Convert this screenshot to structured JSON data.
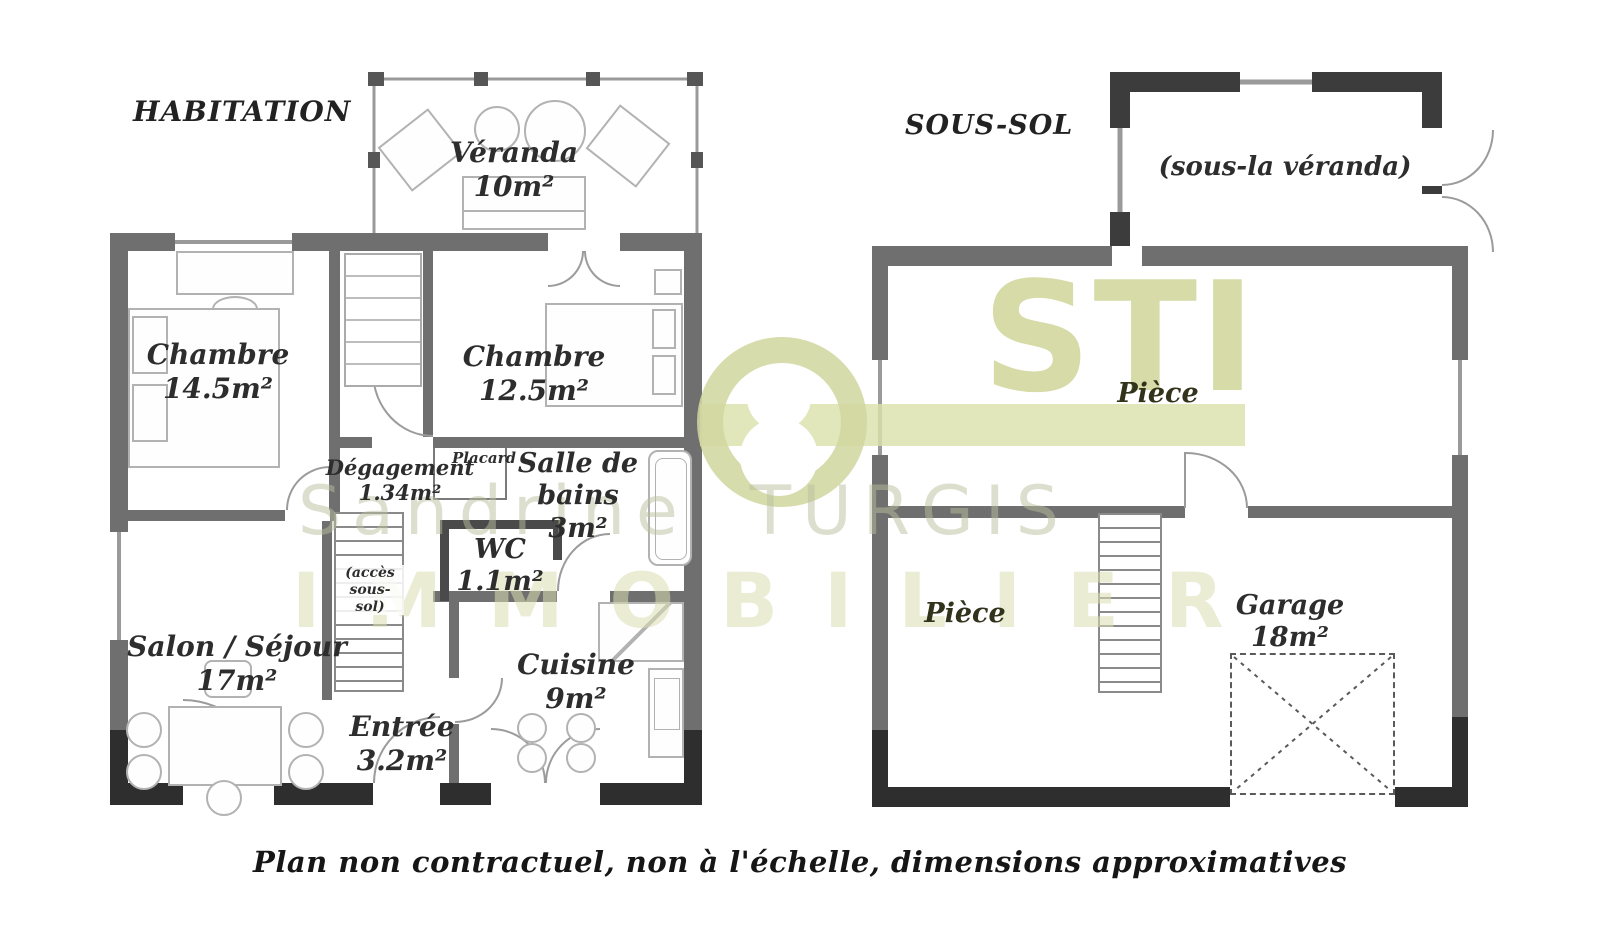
{
  "titles": {
    "left": "HABITATION",
    "right": "SOUS-SOL"
  },
  "caption": "Plan non contractuel, non à l'échelle, dimensions approximatives",
  "watermark": {
    "logo": "STI",
    "name": "Sandrine TURGIS",
    "word": "IMMOBILIER",
    "color": "#d5daa5"
  },
  "habitation": {
    "veranda": {
      "name": "Véranda",
      "area": "10m²"
    },
    "chambre1": {
      "name": "Chambre",
      "area": "14.5m²"
    },
    "chambre2": {
      "name": "Chambre",
      "area": "12.5m²"
    },
    "degagement": {
      "name": "Dégagement",
      "area": "1.34m²"
    },
    "placard": {
      "name": "Placard"
    },
    "sdb": {
      "name": "Salle de bains",
      "area": "3m²"
    },
    "wc": {
      "name": "WC",
      "area": "1.1m²"
    },
    "salon": {
      "name": "Salon / Séjour",
      "area": "17m²"
    },
    "acces": {
      "note": "(accès sous-sol)"
    },
    "entree": {
      "name": "Entrée",
      "area": "3.2m²"
    },
    "cuisine": {
      "name": "Cuisine",
      "area": "9m²"
    }
  },
  "sous_sol": {
    "sous_veranda": {
      "note": "(sous-la véranda)"
    },
    "piece_haut": {
      "name": "Pièce"
    },
    "piece_bas": {
      "name": "Pièce"
    },
    "garage": {
      "name": "Garage",
      "area": "18m²"
    }
  }
}
